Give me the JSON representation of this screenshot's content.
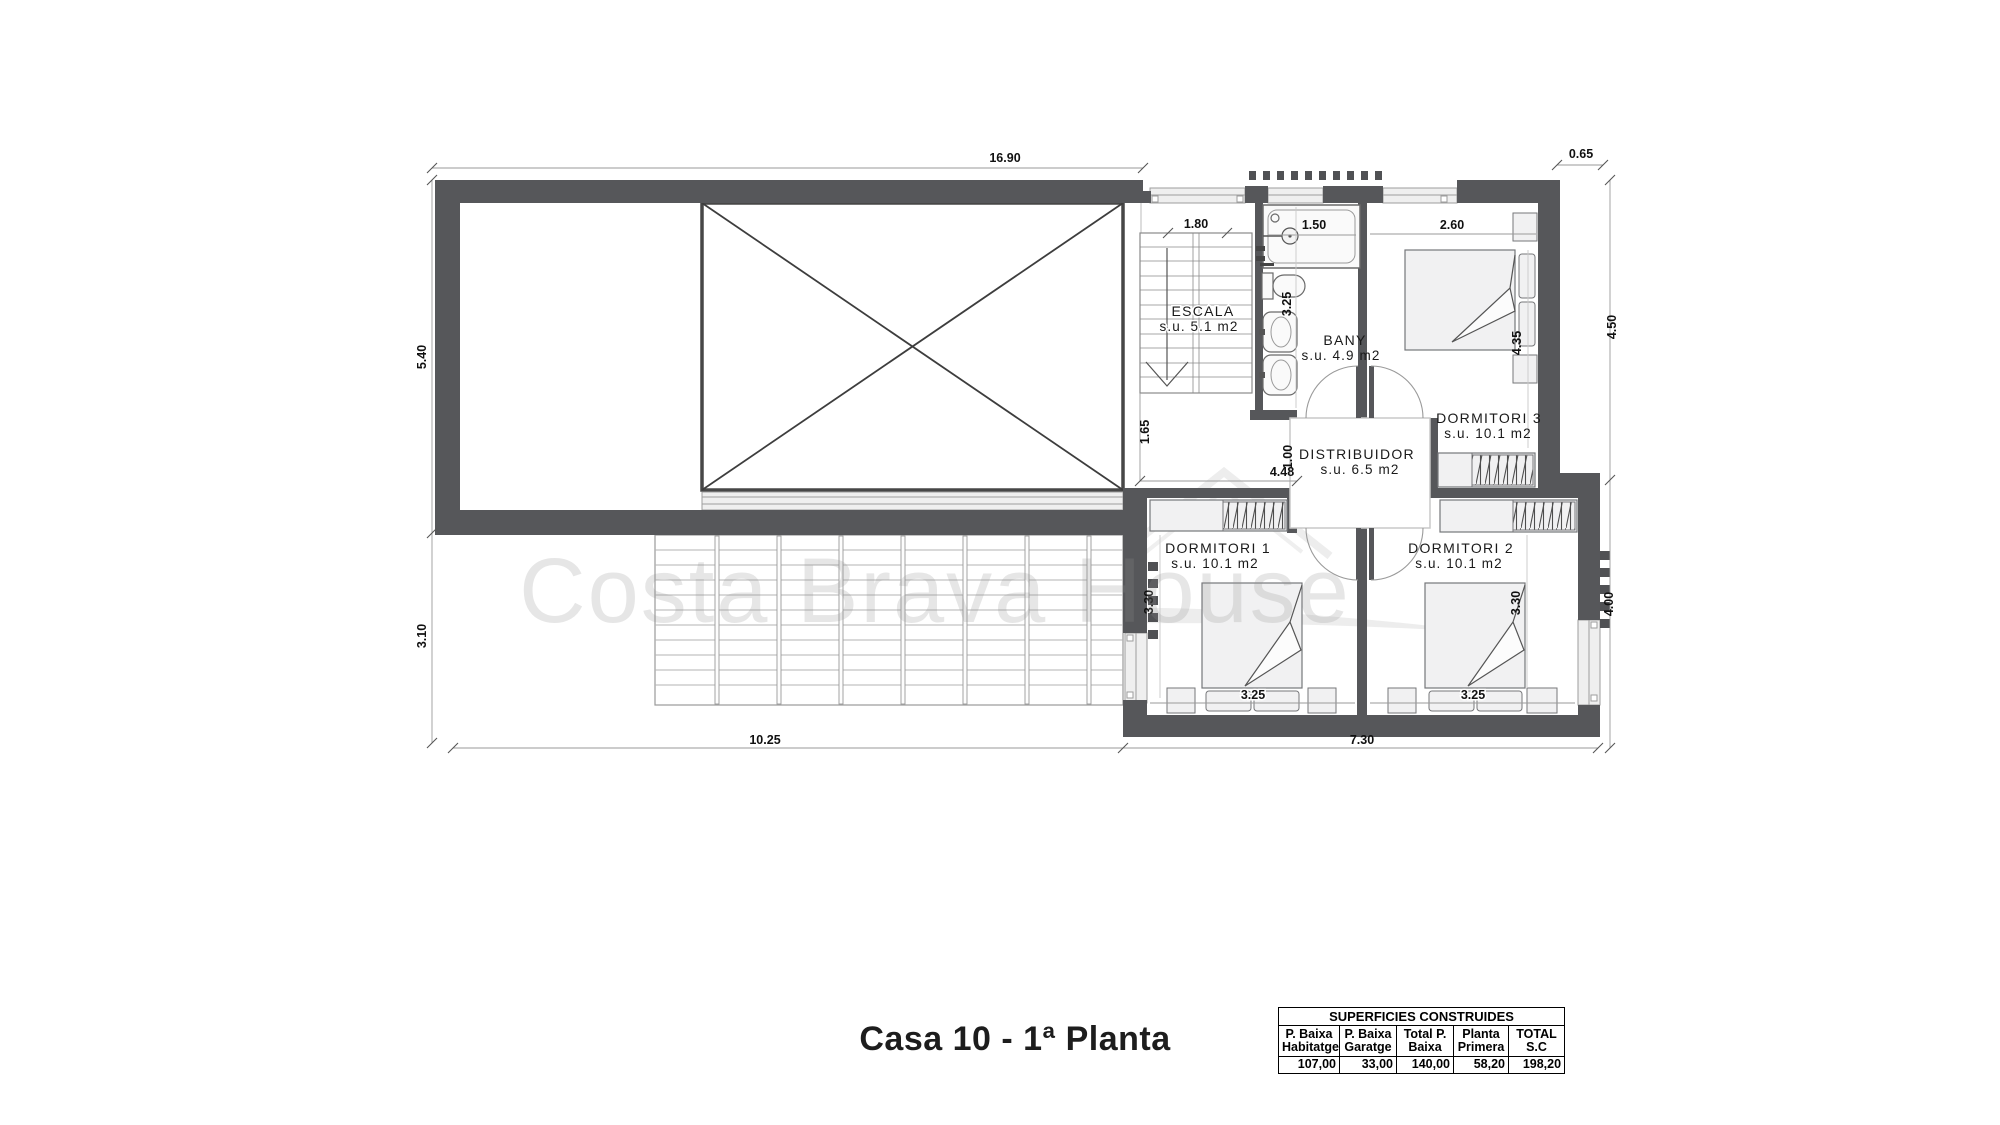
{
  "title": "Casa 10 - 1ª Planta",
  "watermark": "Costa Brava House",
  "rooms": {
    "escala": {
      "name": "ESCALA",
      "area": "s.u. 5.1 m2"
    },
    "bany": {
      "name": "BANY",
      "area": "s.u. 4.9 m2"
    },
    "distribuidor": {
      "name": "DISTRIBUIDOR",
      "area": "s.u. 6.5 m2"
    },
    "dormitori1": {
      "name": "DORMITORI 1",
      "area": "s.u. 10.1 m2"
    },
    "dormitori2": {
      "name": "DORMITORI 2",
      "area": "s.u. 10.1 m2"
    },
    "dormitori3": {
      "name": "DORMITORI 3",
      "area": "s.u. 10.1 m2"
    }
  },
  "dims": {
    "top_width": "16.90",
    "offset_top_right": "0.65",
    "left_upper": "5.40",
    "left_lower": "3.10",
    "right_upper": "4.50",
    "right_lower": "4.00",
    "bottom_left": "10.25",
    "bottom_right": "7.30",
    "stair_width": "1.80",
    "bath_tub": "1.50",
    "dorm3_width": "2.60",
    "bany_depth": "3.25",
    "landing": "1.65",
    "hall_gap": "1.00",
    "hall_width": "4.48",
    "dorm1_depth": "3.30",
    "dorm2_depth": "3.30",
    "dorm3_depth": "4.35",
    "dorm1_width": "3.25",
    "dorm2_width": "3.25"
  },
  "table": {
    "title": "SUPERFICIES CONSTRUIDES",
    "columns": [
      {
        "header_line1": "P. Baixa",
        "header_line2": "Habitatge",
        "value": "107,00"
      },
      {
        "header_line1": "P. Baixa",
        "header_line2": "Garatge",
        "value": "33,00"
      },
      {
        "header_line1": "Total P.",
        "header_line2": "Baixa",
        "value": "140,00"
      },
      {
        "header_line1": "Planta",
        "header_line2": "Primera",
        "value": "58,20"
      },
      {
        "header_line1": "TOTAL",
        "header_line2": "S.C",
        "value": "198,20"
      }
    ]
  },
  "colors": {
    "wall": "#56575a",
    "thin_line": "#4a4a4a",
    "furniture_fill": "#f1f1f2",
    "furniture_stroke": "#76777a",
    "dim_line": "#9a9a9a",
    "watermark": "#8f8f8f"
  }
}
